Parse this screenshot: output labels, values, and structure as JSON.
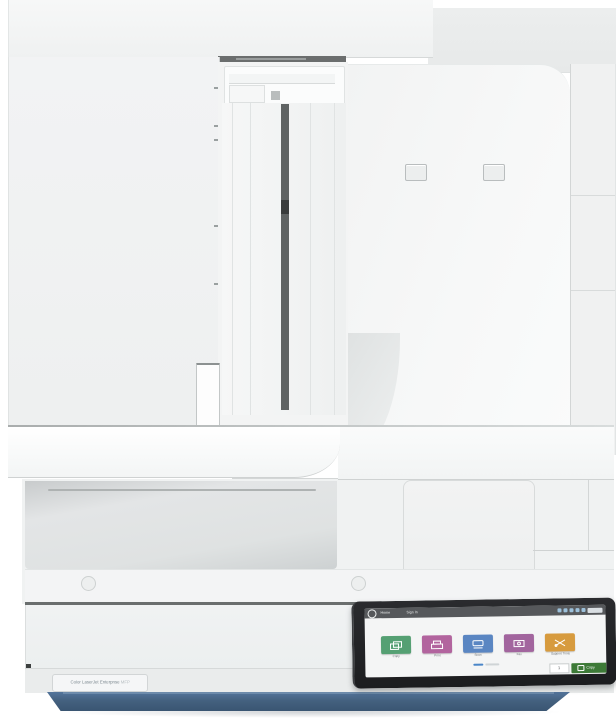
{
  "product": {
    "name_plate": {
      "main": "Color LaserJet Enterprise",
      "suffix": "MFP"
    }
  },
  "screen": {
    "topbar": {
      "logo_icon": "hp-logo-icon",
      "home_label": "Home",
      "sign_in_label": "Sign In",
      "status_icons": [
        "tray-status-icon",
        "document-status-icon",
        "info-icon",
        "network-icon",
        "clock-icon"
      ]
    },
    "tiles": [
      {
        "label": "Copy",
        "color": "#55a073",
        "icon": "copy-icon"
      },
      {
        "label": "Print",
        "color": "#b2649e",
        "icon": "print-icon"
      },
      {
        "label": "Scan",
        "color": "#5a86c2",
        "icon": "scan-icon"
      },
      {
        "label": "Fax",
        "color": "#a2659e",
        "icon": "fax-icon"
      },
      {
        "label": "Support Tools",
        "color": "#d79b3e",
        "icon": "support-tools-icon"
      }
    ],
    "pager": {
      "page_count": 2,
      "active_page": 1
    },
    "copy_count": "1",
    "start_button": {
      "label": "Copy",
      "color": "#3d7a37"
    },
    "colors": {
      "topbar": "#56585b",
      "background": "#f4f5f5",
      "accent_blue": "#4a86c8"
    }
  },
  "device_colors": {
    "base_bar": "#44617f",
    "body": "#f0f2f2",
    "bezel": "#1f2022"
  }
}
